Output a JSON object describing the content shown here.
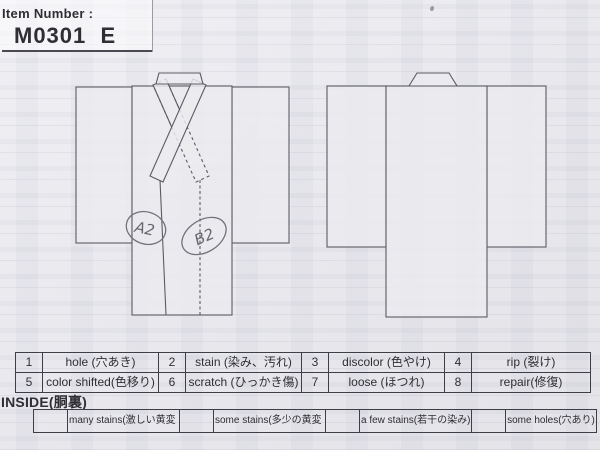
{
  "header": {
    "label": "Item Number :",
    "item_number": "M0301  E"
  },
  "diagrams": {
    "front": {
      "marks": [
        {
          "label": "A2"
        },
        {
          "label": "B2"
        }
      ]
    },
    "back": {}
  },
  "defect_table": {
    "rows": [
      {
        "cells": [
          {
            "num": "1",
            "label": "hole (穴あき)"
          },
          {
            "num": "2",
            "label": "stain (染み、汚れ)"
          },
          {
            "num": "3",
            "label": "discolor (色やけ)"
          },
          {
            "num": "4",
            "label": "rip (裂け)"
          }
        ]
      },
      {
        "cells": [
          {
            "num": "5",
            "label": "color shifted(色移り)"
          },
          {
            "num": "6",
            "label": "scratch (ひっかき傷)"
          },
          {
            "num": "7",
            "label": "loose (ほつれ)"
          },
          {
            "num": "8",
            "label": "repair(修復)"
          }
        ]
      }
    ]
  },
  "inside": {
    "title": "INSIDE(胴裏)",
    "options": [
      {
        "label": "many stains(激しい黄変・染み)"
      },
      {
        "label": "some stains(多少の黄変・染み)"
      },
      {
        "label": "a few stains(若干の染み)"
      },
      {
        "label": "some holes(穴あり)"
      }
    ]
  },
  "colors": {
    "paper": "#e9e9ed",
    "ink": "#2e2e33",
    "table_line": "#3e3e46",
    "pencil": "#72727b"
  }
}
